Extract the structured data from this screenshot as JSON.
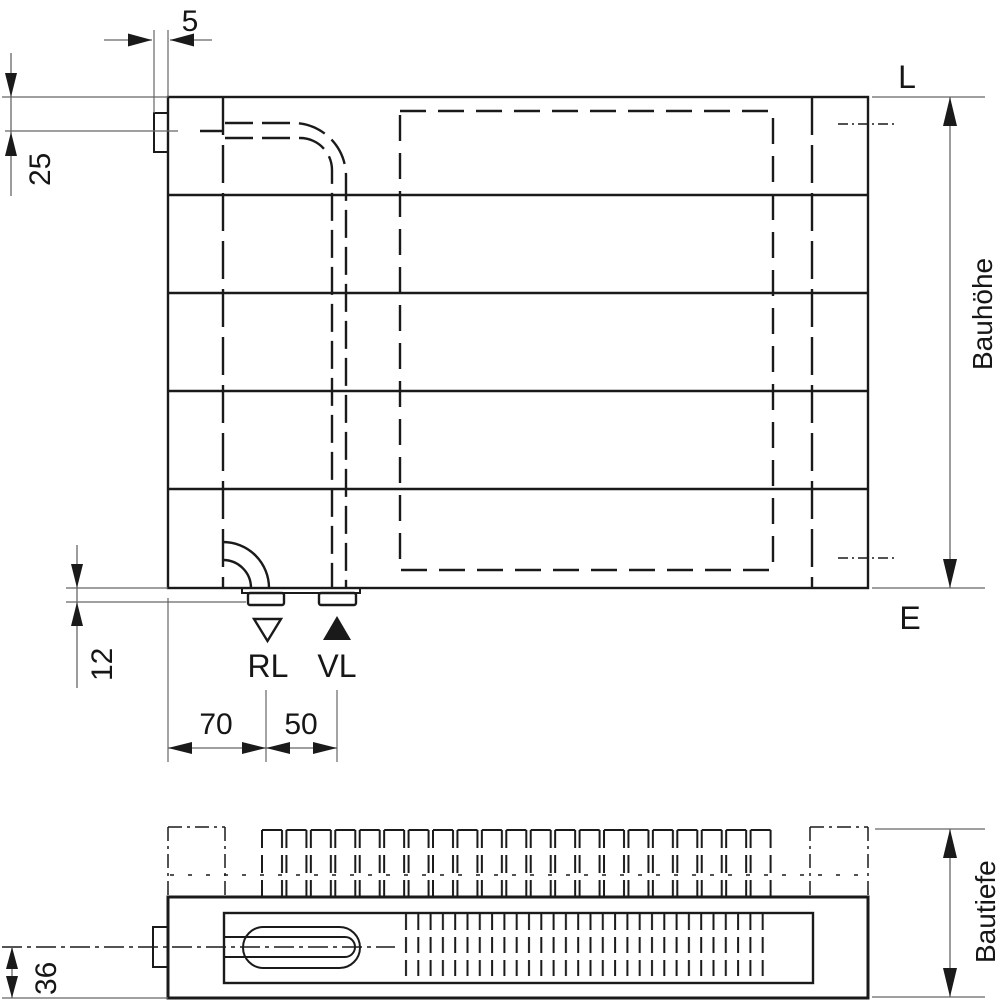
{
  "drawing": {
    "front_view": {
      "dim_bracket_gap": "5",
      "dim_top_connection": "25",
      "dim_bottom_clearance": "12",
      "dim_return_pitch": "70",
      "dim_flow_pitch": "50",
      "label_top_right": "L",
      "label_bottom_right": "E",
      "label_return": "RL",
      "label_flow": "VL",
      "label_height": "Bauhöhe"
    },
    "bottom_view": {
      "dim_depth_to_center": "36",
      "label_depth": "Bautiefe"
    },
    "colors": {
      "line": "#1a1a1a",
      "thin_line": "#666666"
    }
  }
}
